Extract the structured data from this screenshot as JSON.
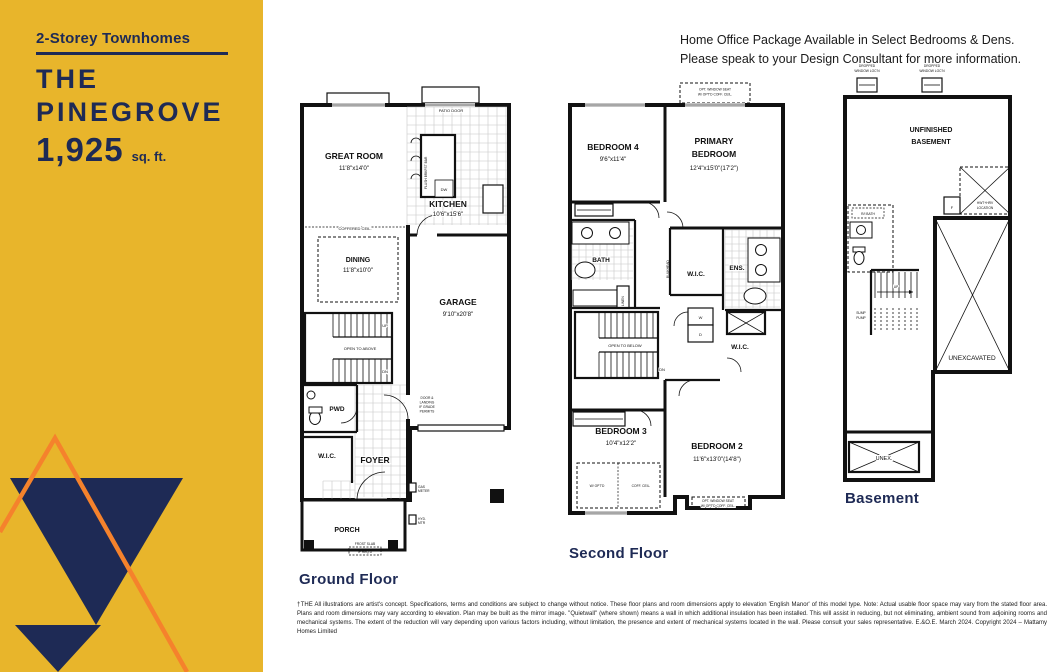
{
  "palette": {
    "yellow": "#E8B52B",
    "navy": "#1E2A55",
    "orange": "#F5822C",
    "ink": "#111111"
  },
  "sidebar": {
    "category": "2-Storey Townhomes",
    "title_line1": "THE",
    "title_line2": "PINEGROVE",
    "area_value": "1,925",
    "area_unit": "sq. ft."
  },
  "header": {
    "line1": "Home Office Package Available in Select Bedrooms & Dens.",
    "line2": "Please speak to your Design Consultant for more information."
  },
  "g": {
    "label": "Ground Floor",
    "great": {
      "n": "GREAT ROOM",
      "d": "11'8\"x14'0\""
    },
    "kitchen": {
      "n": "KITCHEN",
      "d": "10'6\"x15'6\""
    },
    "dining": {
      "n": "DINING",
      "d": "11'8\"x10'0\""
    },
    "garage": {
      "n": "GARAGE",
      "d": "9'10\"x20'8\""
    },
    "pwd": "PWD",
    "wic": "W.I.C.",
    "foyer": "FOYER",
    "porch": "PORCH",
    "patio_door": "PATIO DOOR",
    "coffered": "COFFERED CEIL.",
    "island": "FLUSH BRKFST BAR",
    "dw": "DW",
    "open_above": "OPEN TO ABOVE",
    "up": "UP",
    "dn": "DN",
    "door_note": [
      "DOOR &",
      "LANDING",
      "IF GRADE",
      "PERMITS"
    ],
    "gas": [
      "GAS",
      "METER"
    ],
    "hyd": [
      "HYD.",
      "MTR"
    ],
    "frost": [
      "FROST SLAB",
      "IF REQ'D"
    ]
  },
  "s": {
    "label": "Second Floor",
    "bed4": {
      "n": "BEDROOM 4",
      "d": "9'6\"x11'4\""
    },
    "primary": {
      "n1": "PRIMARY",
      "n2": "BEDROOM",
      "d": "12'4\"x15'0\"(17'2\")"
    },
    "bath": "BATH",
    "wic": "W.I.C.",
    "ens": "ENS.",
    "wic2": "W.I.C.",
    "bed3": {
      "n": "BEDROOM 3",
      "d": "10'4\"x12'2\""
    },
    "bed2": {
      "n": "BEDROOM 2",
      "d": "11'6\"x13'0\"(14'8\")"
    },
    "seat_note": [
      "OPT. WINDOW SEAT",
      "W/ OPT'D COFF. CEIL."
    ],
    "coff_note": [
      "W/ OPT'D",
      "COFF. CEIL."
    ],
    "open_below": "OPEN TO BELOW",
    "dn": "DN",
    "linen": "LINEN",
    "bulkhead": "BULKHEAD",
    "w": "W",
    "d": "D"
  },
  "b": {
    "label": "Basement",
    "unfinished": [
      "UNFINISHED",
      "BASEMENT"
    ],
    "unexcavated": "UNEXCAVATED",
    "unex": "UNEX.",
    "window_note": [
      "DROPPED",
      "WINDOW LOC'N"
    ],
    "mech": [
      "HWT+HRV",
      "LOCATION"
    ],
    "f": "F",
    "bath_ri": "R/I BATH",
    "up": "UP",
    "sump": [
      "SUMP",
      "PUMP"
    ]
  },
  "disclaimer": "†THE All illustrations are artist's concept. Specifications, terms and conditions are subject to change without notice. These floor plans and room dimensions apply to elevation 'English Manor' of this model type. Note: Actual usable floor space may vary from the stated floor area. Plans and room dimensions may vary according to elevation. Plan may be built as the mirror image. \"Quietwall\" (where shown) means a wall in which additional insulation has been installed. This will assist in reducing, but not eliminating, ambient sound from adjoining rooms and mechanical systems. The extent of the reduction will vary depending upon various factors including, without limitation, the presence and extent of mechanical systems located in the wall. Please consult your sales representative. E.&O.E. March 2024. Copyright 2024 – Mattamy Homes Limited"
}
